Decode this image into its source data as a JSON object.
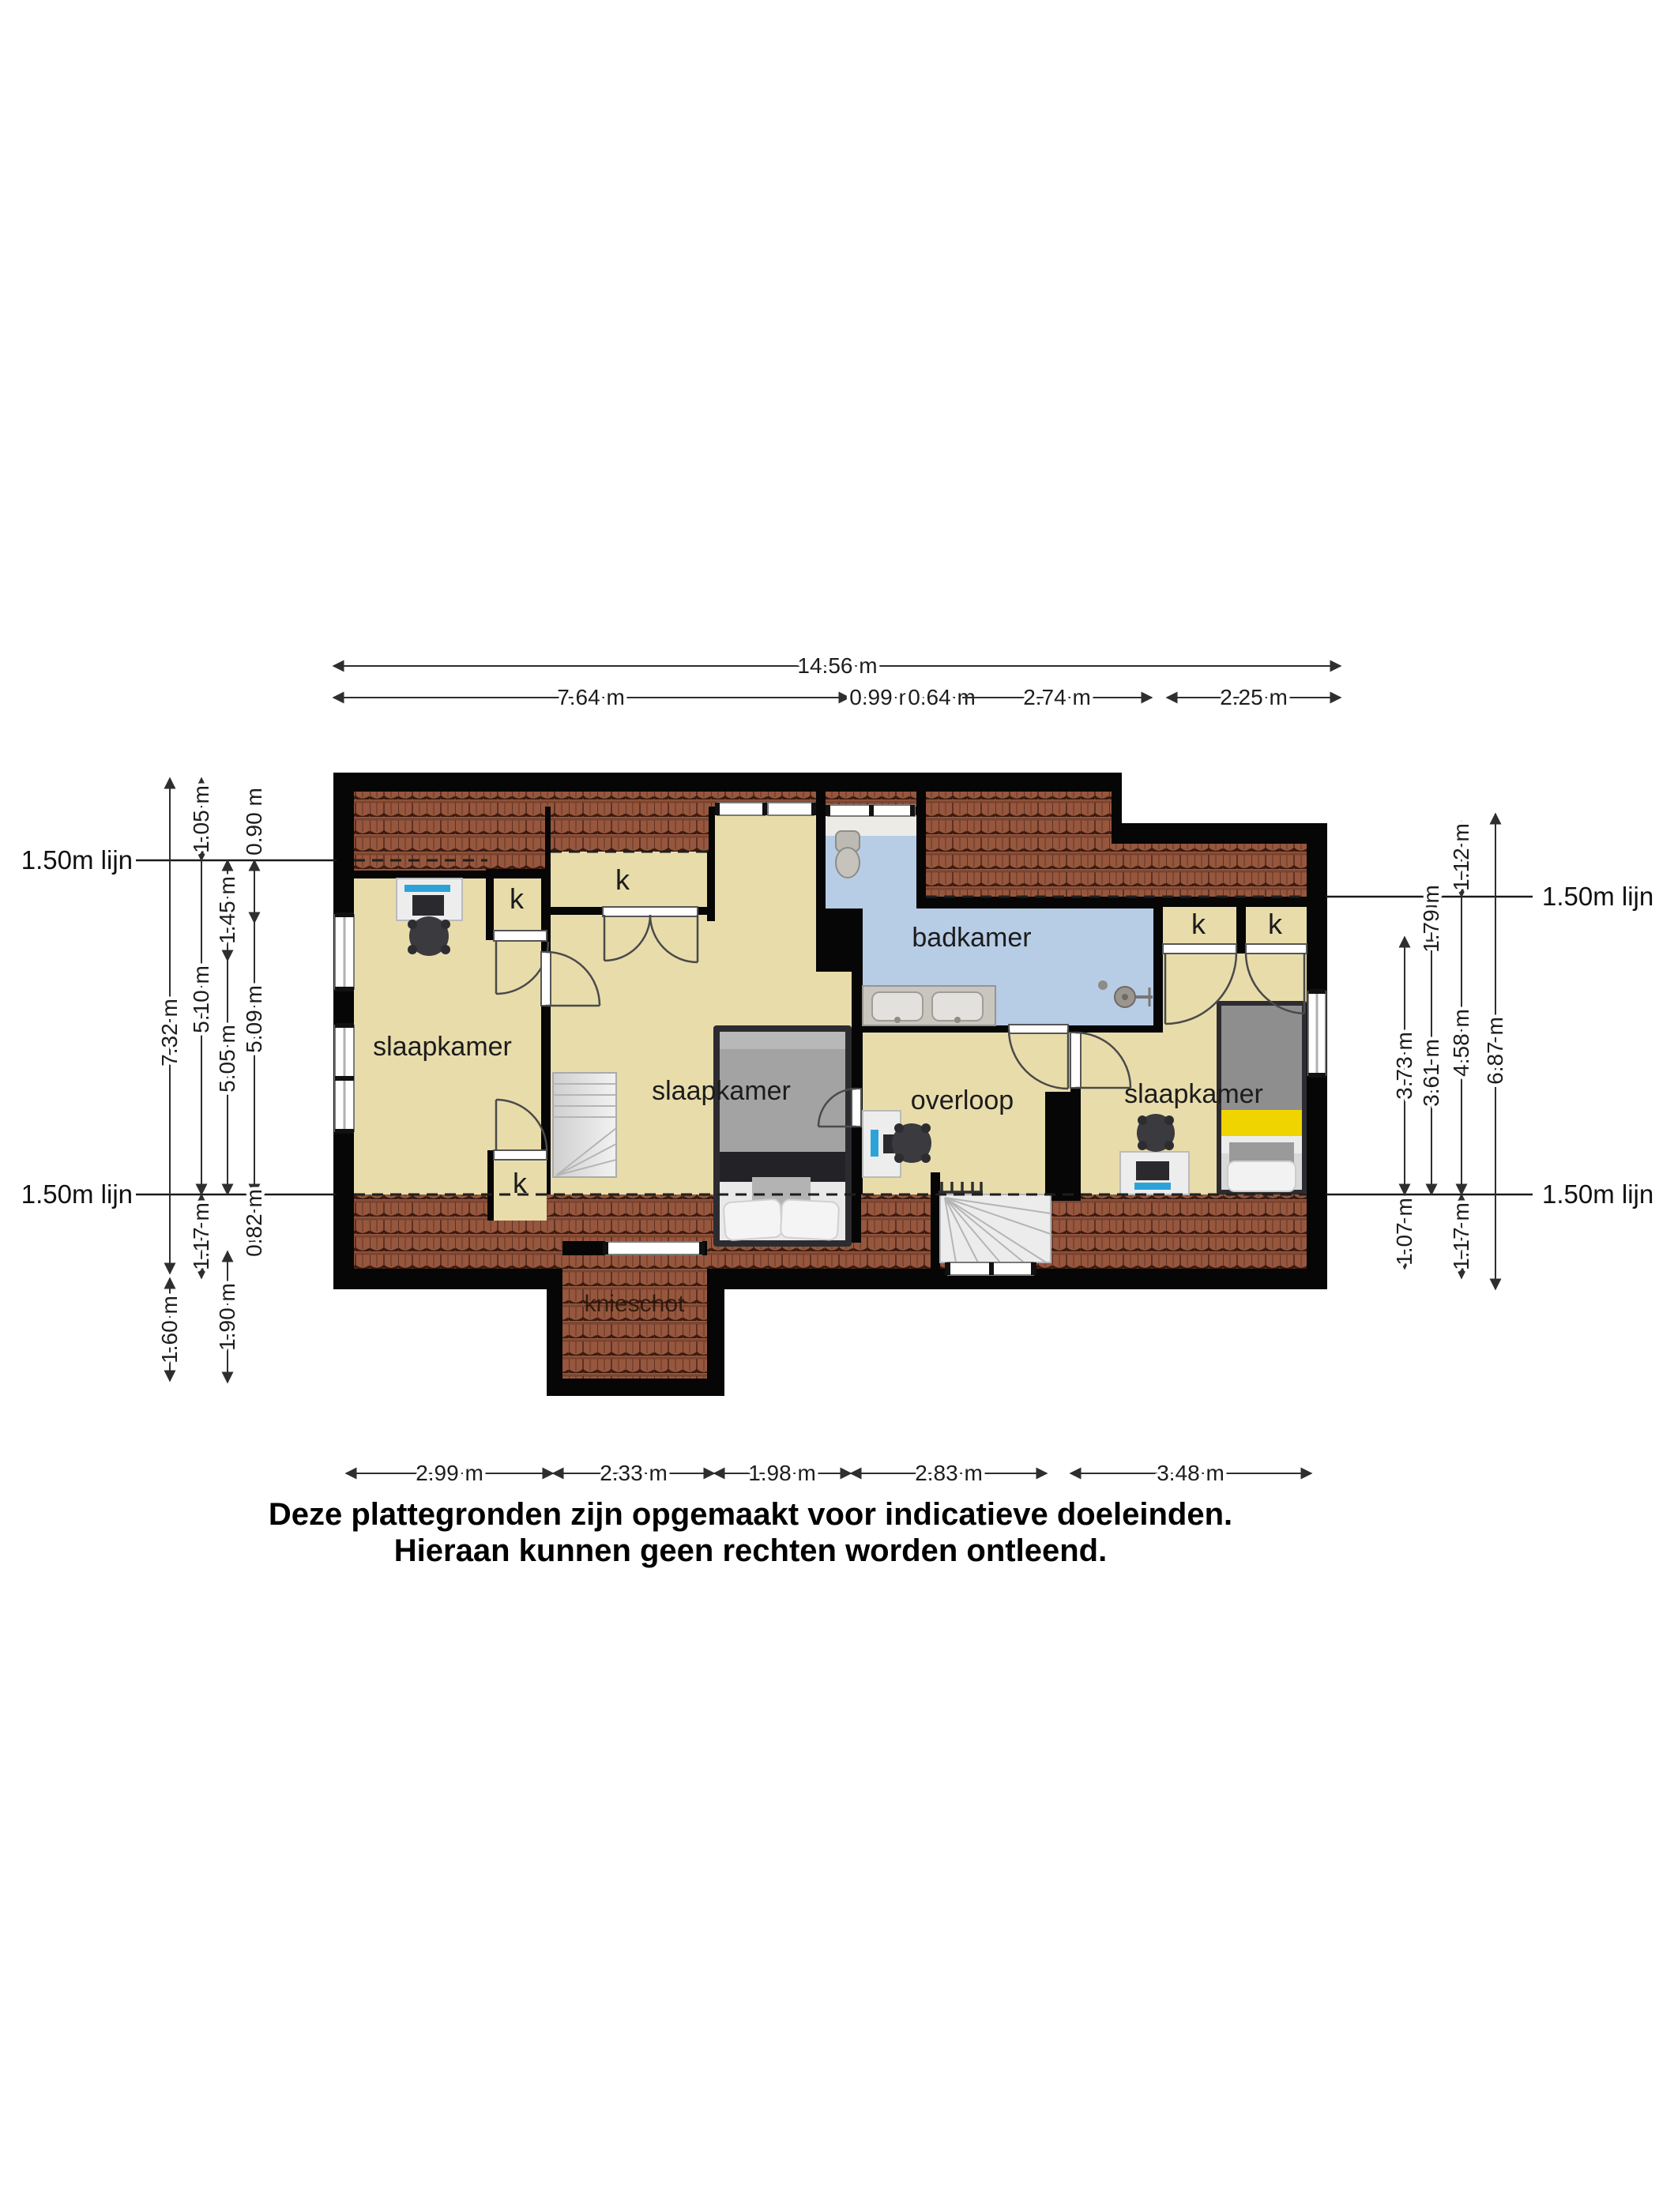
{
  "labels": {
    "line150": "1.50m lijn",
    "room_bedroom": "slaapkamer",
    "room_bathroom": "badkamer",
    "room_landing": "overloop",
    "room_kneewall": "knieschot",
    "closet": "k"
  },
  "dims": {
    "top_total": "14.56 m",
    "top": [
      "7.64 m",
      "0.99 m",
      "0.64 m",
      "2.74 m",
      "2.25 m"
    ],
    "left": [
      "1.05 m",
      "0.90 m",
      "1.45 m",
      "7.32 m",
      "5.10 m",
      "5.05 m",
      "5.09 m",
      "1.17 m",
      "0.82 m",
      "1.60 m",
      "1.90 m"
    ],
    "right": [
      "1.12 m",
      "1.79 m",
      "3.73 m",
      "4.58 m",
      "6.87 m",
      "3.61 m",
      "1.07 m",
      "1.17 m"
    ],
    "bottom": [
      "2.99 m",
      "2.33 m",
      "1.98 m",
      "2.83 m",
      "3.48 m"
    ]
  },
  "disclaimer": [
    "Deze plattegronden zijn opgemaakt voor indicatieve doeleinden.",
    "Hieraan kunnen geen rechten worden ontleend."
  ],
  "colors": {
    "wall": "#060606",
    "floor_tan": "#e8dcab",
    "bathroom_blue": "#b7cde6",
    "roof_tile": "#96573e",
    "roof_tile_dark": "#3b1b10",
    "stair_gray": "#ececec",
    "bed_yellow": "#efd400",
    "monitor_blue": "#2ba3d9",
    "furniture_dark": "#3a3a3f",
    "bed_dark": "#2c2c30"
  }
}
